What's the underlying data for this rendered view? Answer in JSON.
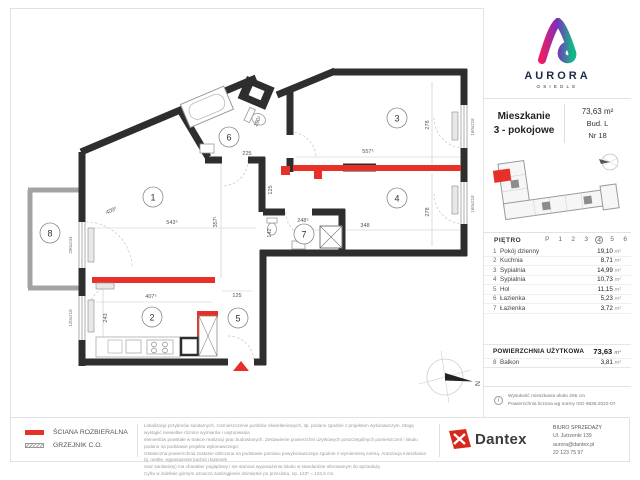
{
  "header": {
    "brand_name": "AURORA",
    "brand_subtitle": "OSIEDLE",
    "unit_type": "Mieszkanie",
    "unit_rooms": "3 - pokojowe",
    "unit_area": "73,63 m²",
    "unit_building": "Bud. L",
    "unit_number": "Nr 18"
  },
  "floor_selector": {
    "label": "PIĘTRO",
    "options": [
      "P",
      "1",
      "2",
      "3",
      "4",
      "5",
      "6"
    ],
    "selected": "4"
  },
  "rooms_table": {
    "area_unit": "m²",
    "rows": [
      {
        "no": "1",
        "name": "Pokój dzienny",
        "area": "19,10"
      },
      {
        "no": "2",
        "name": "Kuchnia",
        "area": "8,71"
      },
      {
        "no": "3",
        "name": "Sypialnia",
        "area": "14,99"
      },
      {
        "no": "4",
        "name": "Sypialnia",
        "area": "10,73"
      },
      {
        "no": "5",
        "name": "Hol",
        "area": "11,15"
      },
      {
        "no": "6",
        "name": "Łazienka",
        "area": "5,23"
      },
      {
        "no": "7",
        "name": "Łazienka",
        "area": "3,72"
      }
    ],
    "summary_label": "POWIERZCHNIA UŻYTKOWA",
    "summary_area": "73,63",
    "balcony_row": {
      "no": "8",
      "name": "Balkon",
      "area": "3,81"
    }
  },
  "notes": {
    "icon": "i",
    "line1": "Wysokość mieszkania około 265 cm",
    "line2": "Powierzchnia liczona wg normy ISO 9836:2022-07"
  },
  "legend": {
    "demountable_wall": "ŚCIANA ROZBIERALNA",
    "radiator": "GRZEJNIK C.O."
  },
  "disclaimer": {
    "line1": "Lokalizację przyborów sanitarnych, rozmieszczenie punktów oświetleniowych, itp. podano zgodnie z projektem wykonawczym. Mogą wystąpić niewielkie różnice wymiarów i usytuowania",
    "line2": "elementów powstałe w trakcie realizacji prac budowlanych. Zestawienie powierzchni użytkowych poszczególnych pomieszczeń i lokalu podano na podstawie projektu wykonawczego;",
    "line3": "Ostateczna powierzchnia zostanie obliczona na podstawie pomiaru powykonawczego zgodnie z wymienioną normą. Aranżacja mieszkania (tj. meble, wyposażenie kuchni i łazienek",
    "line4": "oraz sanitariaty) ma charakter poglądowy i nie stanowi wyposażenia lokalu w standardzie oferowanym do sprzedaży.",
    "line5": "Cyfra w indeksie górnym oznacza zaokrąglenie dziesiętne po przecinku, np. 123⁵ = 123,5 cm."
  },
  "vendor": {
    "logo_text": "Dantex",
    "office_label": "BIURO SPRZEDAŻY",
    "address": "Ul. Jutrzenki 139",
    "email": "aurora@dantex.pl",
    "phone": "22 123 75 97"
  },
  "plan": {
    "compass": "N",
    "rooms": {
      "r1": "1",
      "r2": "2",
      "r3": "3",
      "r4": "4",
      "r5": "5",
      "r6": "6",
      "r7": "7",
      "r8": "8"
    },
    "dims": {
      "living_width": "543⁵",
      "living_height": "357¹",
      "living_diag": "409⁵",
      "bath6_width": "225",
      "bath6_diag": "190¹",
      "bed3_width": "557⁵",
      "bed3_height": "278",
      "bed4_width": "348",
      "bed4_height": "278",
      "bath7_width": "248⁵",
      "bath7_height": "142",
      "hall_width": "125",
      "corridor_width": "125",
      "kitchen_width": "407⁵",
      "kitchen_height": "243"
    },
    "windows": {
      "balcony_door": "200x234",
      "kitchen_window": "120x218",
      "bed3_window": "160x218",
      "bed4_window": "160x218"
    },
    "colors": {
      "wall": "#2e2e2e",
      "accent_red": "#e73128",
      "balcony_gray": "#a3a3a3"
    }
  }
}
